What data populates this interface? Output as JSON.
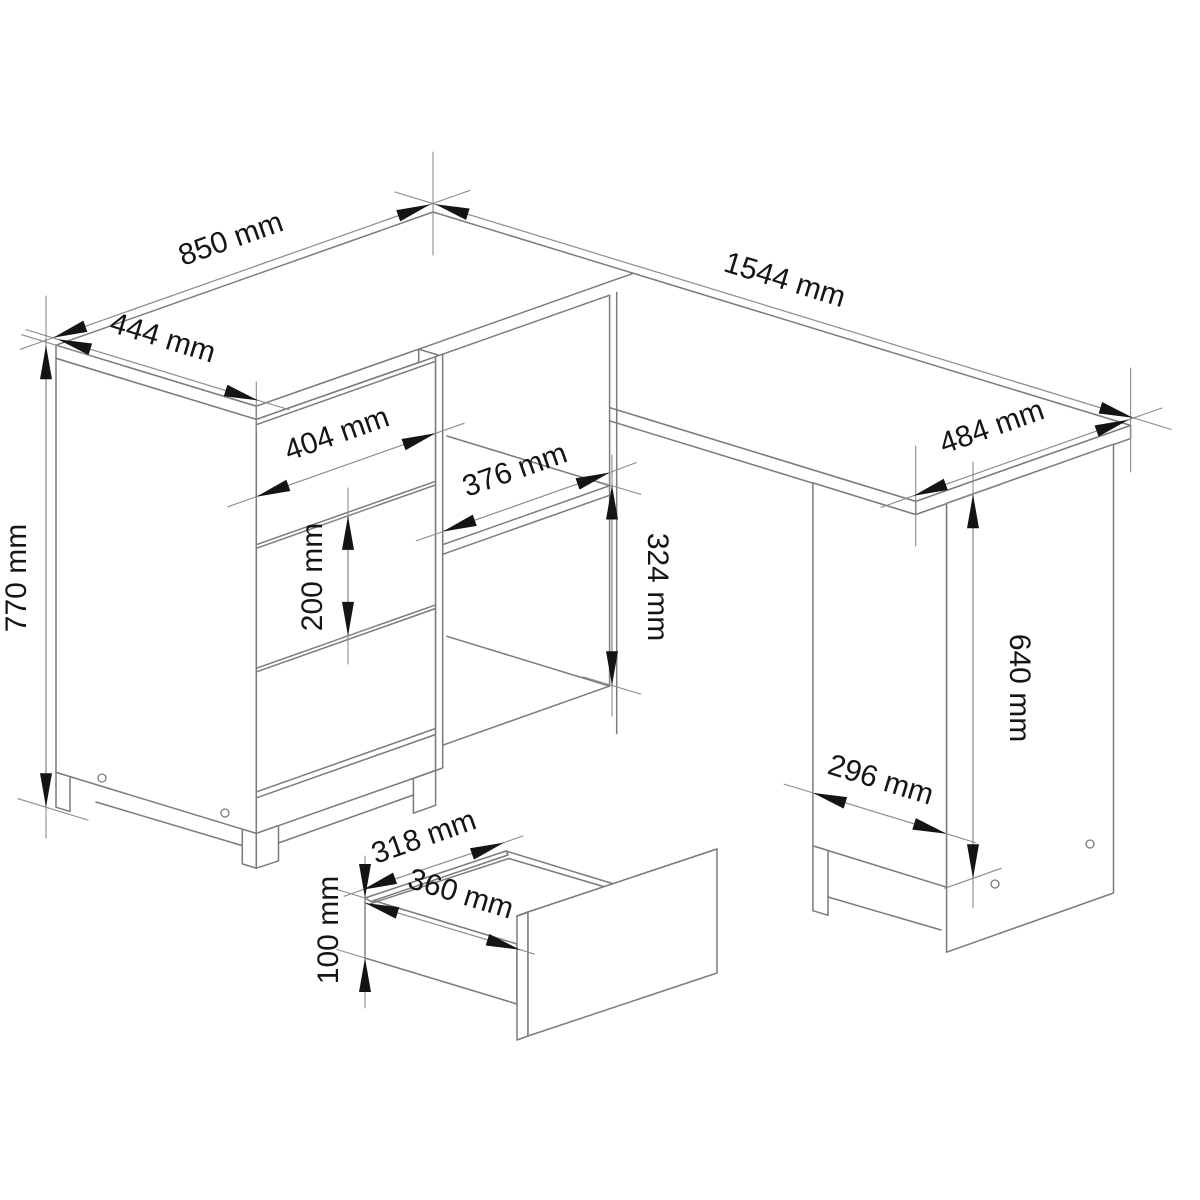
{
  "drawing": {
    "type": "isometric-furniture-dimension-diagram",
    "subject": "corner desk with three-drawer pedestal, open shelf compartment, side cabinet and pulled-out drawer",
    "unit": "mm",
    "background_color": "#ffffff",
    "line_color": "#7b7b7b",
    "arrow_text_color": "#141414"
  },
  "dims": {
    "d850": {
      "label": "850 mm",
      "value": 850,
      "meaning": "desk top depth, left return"
    },
    "d444": {
      "label": "444 mm",
      "value": 444,
      "meaning": "left return width"
    },
    "d1544": {
      "label": "1544 mm",
      "value": 1544,
      "meaning": "desk total length"
    },
    "d484": {
      "label": "484 mm",
      "value": 484,
      "meaning": "desk top depth, right end"
    },
    "d770": {
      "label": "770 mm",
      "value": 770,
      "meaning": "desk total height"
    },
    "d404": {
      "label": "404 mm",
      "value": 404,
      "meaning": "drawer front width"
    },
    "d376": {
      "label": "376 mm",
      "value": 376,
      "meaning": "shelf compartment opening width"
    },
    "d324": {
      "label": "324 mm",
      "value": 324,
      "meaning": "shelf compartment opening height"
    },
    "d200": {
      "label": "200 mm",
      "value": 200,
      "meaning": "drawer front height"
    },
    "d640": {
      "label": "640 mm",
      "value": 640,
      "meaning": "side cabinet height"
    },
    "d296": {
      "label": "296 mm",
      "value": 296,
      "meaning": "side cabinet width"
    },
    "d318": {
      "label": "318 mm",
      "value": 318,
      "meaning": "pull-out drawer inner width"
    },
    "d360": {
      "label": "360 mm",
      "value": 360,
      "meaning": "pull-out drawer depth"
    },
    "d100": {
      "label": "100 mm",
      "value": 100,
      "meaning": "pull-out drawer box height"
    }
  }
}
